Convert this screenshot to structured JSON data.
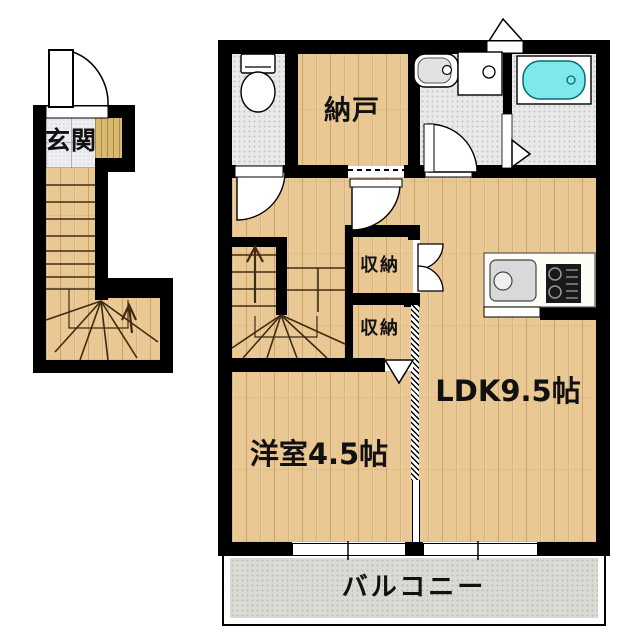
{
  "floorplan": {
    "type": "japanese-apartment-maisonette",
    "colors": {
      "wall": "#000000",
      "wood_floor": "#eac893",
      "tile_floor": "#e9e9eb",
      "entrance_tile": "#edeef2",
      "step_wood": "#d9ba6e",
      "bathtub_water": "#7de9ec",
      "balcony_concrete": "#dbdbd6"
    },
    "first_floor": {
      "rooms": [
        {
          "name": "genkan",
          "label": "玄関"
        }
      ],
      "features": [
        "entrance-swing-door",
        "staircase-up-with-winder",
        "up-arrow"
      ]
    },
    "second_floor": {
      "rooms": [
        {
          "name": "nando",
          "label": "納戸"
        },
        {
          "name": "closet-upper",
          "label": "収納"
        },
        {
          "name": "closet-lower",
          "label": "収納"
        },
        {
          "name": "ldk",
          "label": "LDK9.5帖"
        },
        {
          "name": "western-room",
          "label": "洋室4.5帖"
        },
        {
          "name": "balcony",
          "label": "バルコニー"
        }
      ],
      "fixtures": [
        "toilet",
        "washbasin",
        "washing-machine-pan",
        "bathtub",
        "kitchen-sink",
        "gas-stove"
      ],
      "features": [
        "staircase-winder",
        "double-swing-closet-doors",
        "sliding-door",
        "folding-doors",
        "balcony-windows"
      ]
    }
  }
}
